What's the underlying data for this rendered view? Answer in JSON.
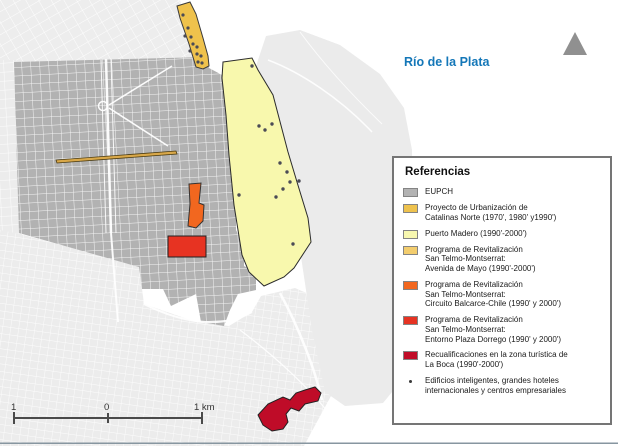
{
  "map": {
    "river_label": "Río de la Plata",
    "scale_bar": {
      "left_label": "1",
      "mid_label": "0",
      "right_label": "1 km"
    }
  },
  "colors": {
    "eupch_fill": "#b2b2b2",
    "land_light": "#ececec",
    "catalinas": "#efc24c",
    "puerto_madero": "#f8f8ad",
    "avenida_mayo": "#d9a849",
    "balcarce_chile": "#f2671f",
    "plaza_dorrego": "#e73322",
    "la_boca": "#bf0c28",
    "building_dot": "#4b4b55",
    "river_label": "#1477b8",
    "north_arrow": "#909090",
    "scale_text": "#333333"
  },
  "legend": {
    "title": "Referencias",
    "items": [
      {
        "color": "#b3b3b3",
        "lines": [
          "EUPCH"
        ]
      },
      {
        "color": "#eec24e",
        "lines": [
          "Proyecto de Urbanización de",
          "Catalinas Norte (1970', 1980' y1990')"
        ]
      },
      {
        "color": "#f8f8b0",
        "lines": [
          "Puerto Madero (1990'-2000')"
        ]
      },
      {
        "color": "#f3cd6e",
        "lines": [
          "Programa de Revitalización",
          "San Telmo-Montserrat:",
          "Avenida de Mayo (1990'-2000')"
        ]
      },
      {
        "color": "#f2671f",
        "lines": [
          "Programa de Revitalización",
          "San Telmo-Montserrat:",
          "Circuito Balcarce-Chile (1990' y 2000')"
        ]
      },
      {
        "color": "#e63323",
        "lines": [
          "Programa de Revitalización",
          "San Telmo-Montserrat:",
          "Entorno Plaza Dorrego (1990' y 2000')"
        ]
      },
      {
        "color": "#c00d28",
        "lines": [
          "Recualificaciones en la zona turística de",
          "La Boca (1990'-2000')"
        ]
      },
      {
        "marker": "building-dot",
        "lines": [
          "Edificios inteligentes, grandes hoteles",
          "internacionales y centros empresariales"
        ]
      }
    ]
  }
}
